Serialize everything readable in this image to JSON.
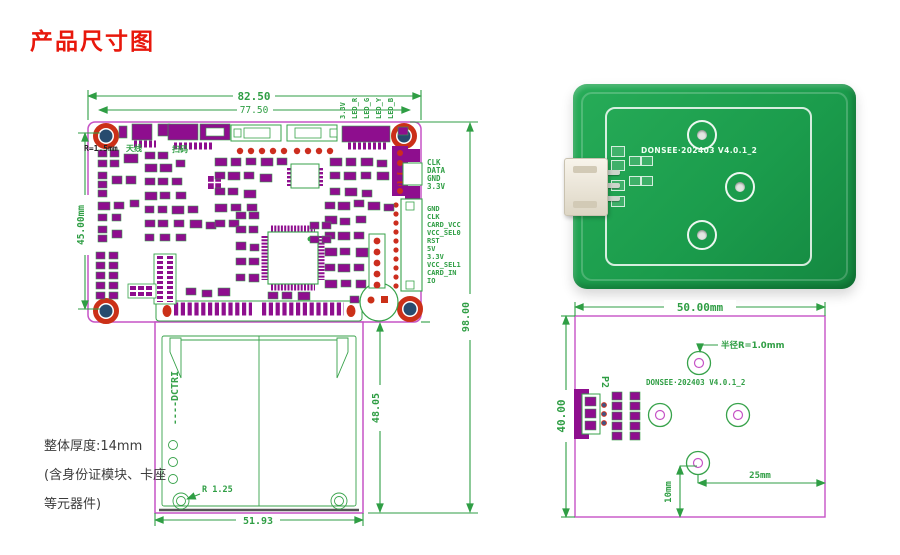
{
  "page": {
    "title": "产品尺寸图"
  },
  "main_drawing": {
    "dim_width_outer": "82.50",
    "dim_width_inner": "77.50",
    "dim_board_height": "45.00mm",
    "dim_total_height": "98.00",
    "dim_card_height": "48.05",
    "dim_card_width": "51.93",
    "corner_radius_label": "R=1.5mm",
    "screw_radius_label": "R 1.25",
    "antenna_label": "天线",
    "scan_label": "扫码",
    "card_slot_label": "----DCTRI",
    "top_pin_labels": [
      "3.3V",
      "LED_R",
      "LED_G",
      "LED_Y",
      "LED_B"
    ],
    "connector1_pins": [
      "CLK",
      "DATA",
      "GND",
      "3.3V"
    ],
    "connector2_pins": [
      "GND",
      "CLK",
      "CARD_VCC",
      "VCC_SEL0",
      "RST",
      "5V",
      "3.3V",
      "VCC_SEL1",
      "CARD_IN",
      "IO"
    ],
    "notes": [
      "整体厚度:14mm",
      "(含身份证模块、卡座",
      "等元器件)"
    ]
  },
  "photo": {
    "silkscreen_text": "DONSEE·202403 V4.0.1_2"
  },
  "antenna_drawing": {
    "dim_width": "50.00mm",
    "dim_height": "40.00",
    "dim_hole_offset_y": "10mm",
    "dim_hole_offset_x": "25mm",
    "hole_radius_label": "半径R=1.0mm",
    "silkscreen_text": "DONSEE·202403 V4.0.1_2",
    "connector_label": "P2"
  },
  "colors": {
    "dimension_green": "#2f9e44",
    "outline_magenta": "#c653c6",
    "component_purple": "#8e0e8e",
    "hole_red": "#cb3018",
    "hole_blue": "#274b6e",
    "title_red": "#e8180c",
    "pcb_green": "#1b9c4c"
  }
}
